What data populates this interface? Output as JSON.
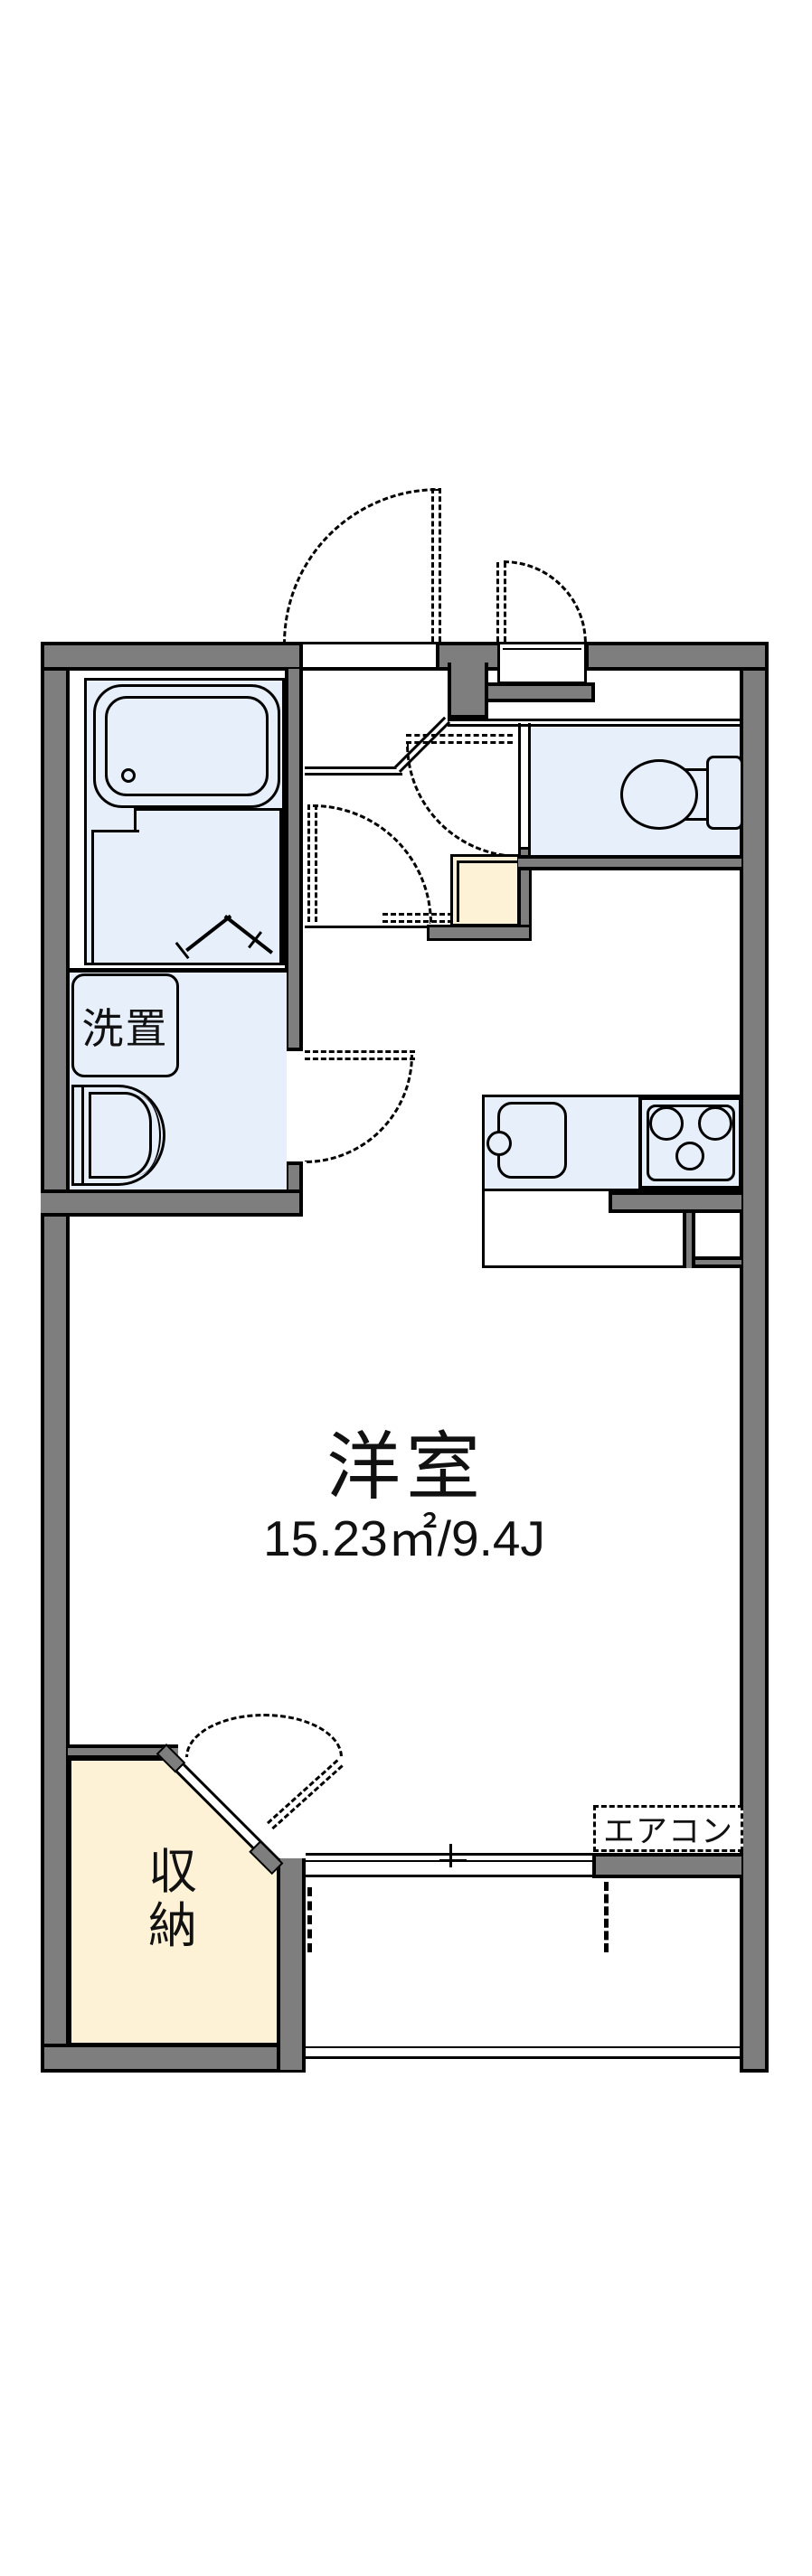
{
  "floorplan": {
    "type": "apartment-floorplan",
    "colors": {
      "wall": "#7e7e7e",
      "outline": "#000000",
      "wet_area_fill": "#e7effb",
      "storage_fill": "#fdf2d6",
      "background": "#ffffff"
    },
    "main_room": {
      "label": "洋室",
      "area_label": "15.23㎡/9.4J"
    },
    "washer_space": {
      "label": "洗置"
    },
    "storage": {
      "label": "収納",
      "label_chars": [
        "収",
        "納"
      ]
    },
    "air_conditioner": {
      "label": "エアコン"
    }
  }
}
